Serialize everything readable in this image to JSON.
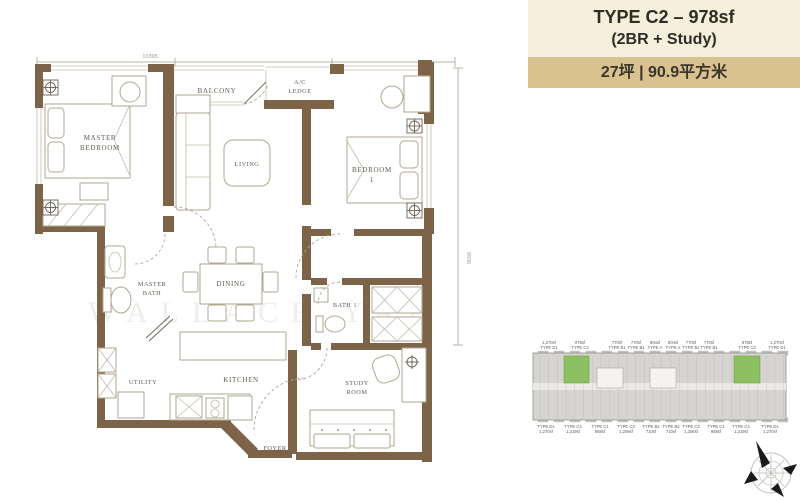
{
  "title_card": {
    "line1": "TYPE C2 – 978sf",
    "line2": "(2BR + Study)",
    "area_line": "27坪 | 90.9平方米",
    "bg_main": "#f5efdc",
    "bg_area": "#d9c190"
  },
  "plan": {
    "dimensions": {
      "top": "10395",
      "right": "9936"
    },
    "watermark": "WALLACE YAP",
    "wall_color": "#7d6449",
    "line_color": "#b2a791",
    "label_color": "#5f5c50",
    "rooms": [
      {
        "id": "master-bedroom",
        "lines": [
          "MASTER",
          "BEDROOM"
        ]
      },
      {
        "id": "balcony",
        "lines": [
          "BALCONY"
        ]
      },
      {
        "id": "ac-ledge",
        "lines": [
          "A/C",
          "LEDGE"
        ]
      },
      {
        "id": "living",
        "lines": [
          "LIVING"
        ]
      },
      {
        "id": "bedroom-1",
        "lines": [
          "BEDROOM",
          "1"
        ]
      },
      {
        "id": "master-bath",
        "lines": [
          "MASTER",
          "BATH"
        ]
      },
      {
        "id": "dining",
        "lines": [
          "DINING"
        ]
      },
      {
        "id": "bath-1",
        "lines": [
          "BATH 1"
        ]
      },
      {
        "id": "utility",
        "lines": [
          "UTILITY"
        ]
      },
      {
        "id": "kitchen",
        "lines": [
          "KITCHEN"
        ]
      },
      {
        "id": "study-room",
        "lines": [
          "STUDY",
          "ROOM"
        ]
      },
      {
        "id": "foyer",
        "lines": [
          "FOYER"
        ]
      }
    ]
  },
  "keyplan": {
    "building_fill": "#d6d4d0",
    "highlight_fill": "#8cc063",
    "top_labels": [
      {
        "area": "1,270sf",
        "type": "TYPE D1"
      },
      {
        "area": "978sf",
        "type": "TYPE C2"
      },
      {
        "area": "770sf",
        "type": "TYPE B1"
      },
      {
        "area": "770sf",
        "type": "TYPE B1"
      },
      {
        "area": "904sf",
        "type": "TYPE A"
      },
      {
        "area": "904sf",
        "type": "TYPE A"
      },
      {
        "area": "770sf",
        "type": "TYPE B1"
      },
      {
        "area": "770sf",
        "type": "TYPE B1"
      },
      {
        "area": "978sf",
        "type": "TYPE C2"
      },
      {
        "area": "1,270sf",
        "type": "TYPE D1"
      }
    ],
    "bottom_labels": [
      {
        "type": "TYPE D1",
        "area": "1,270sf"
      },
      {
        "type": "TYPE C4",
        "area": "1,219sf"
      },
      {
        "type": "TYPE C1",
        "area": "968sf"
      },
      {
        "type": "TYPE C3",
        "area": "1,206sf"
      },
      {
        "type": "TYPE B2",
        "area": "710sf"
      },
      {
        "type": "TYPE B2",
        "area": "710sf"
      },
      {
        "type": "TYPE C3",
        "area": "1,206sf"
      },
      {
        "type": "TYPE C1",
        "area": "968sf"
      },
      {
        "type": "TYPE C4",
        "area": "1,219sf"
      },
      {
        "type": "TYPE D1",
        "area": "1,270sf"
      }
    ]
  }
}
